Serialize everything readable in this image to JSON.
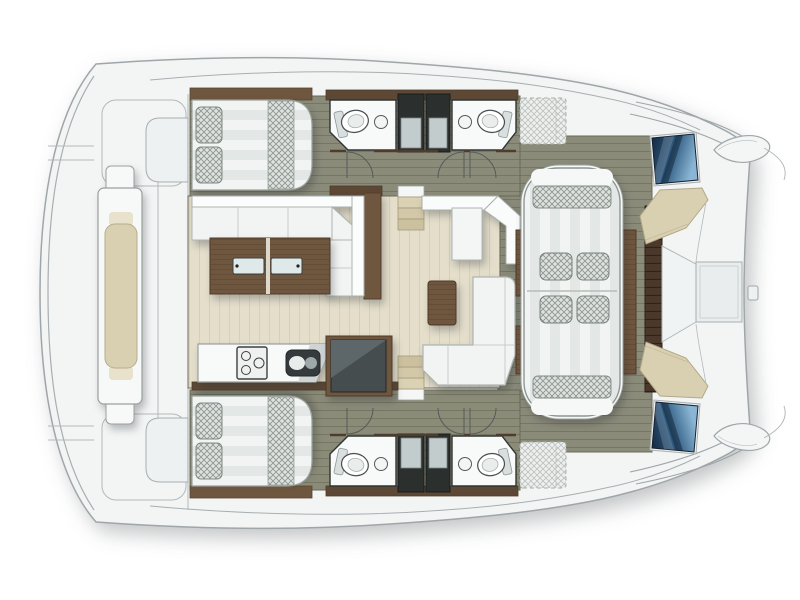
{
  "document": {
    "title": "Catamaran interior layout plan",
    "view": "top-down deck plan",
    "bow_direction": "right",
    "stern_direction": "left"
  },
  "colors": {
    "background": "#ffffff",
    "deck": "#f3f5f5",
    "deckRecess": "#eef1f1",
    "outline": "#9fa6a9",
    "hullFloor": "#8b8b7a",
    "hullFloorLine": "#77775f",
    "salonFloor": "#e4decb",
    "salonFloorLine": "#d7d0b8",
    "wood": "#6f563f",
    "woodLine": "#5e4730",
    "slatWood": "#4a382a",
    "wallWood": "#5d4836",
    "fixtureDark": "#2b2f2e",
    "applianceDark": "#454d4e",
    "upholstery": "#f2f4f3",
    "upholsteryStripe": "#e3e8e6",
    "crosshatchFabric": "#dde2df",
    "crosshatchLine": "#8f9792",
    "cushionBeige": "#d9d0b2",
    "stepBeige": "#dbd2b4",
    "glass": "#dfe9e9",
    "sinkDark": "#353b3d",
    "hatchBlueDark": "#13293f",
    "hatchBlueMid": "#2e5a80",
    "hatchBlueLight": "#8ab5d4"
  },
  "features": [
    {
      "name": "boat-hull-silhouette",
      "label": "Catamaran deck outline, bow to the right"
    },
    {
      "name": "aft-platform",
      "label": "Aft platform / transom deck"
    },
    {
      "name": "aft-bench",
      "label": "Central aft bench with beige cushion"
    },
    {
      "name": "port-hull-floor",
      "label": "Port hull cabin sole (top)"
    },
    {
      "name": "starboard-hull-floor",
      "label": "Starboard hull cabin sole (bottom)"
    },
    {
      "name": "aft-cabin-bed",
      "label": "Double berth with two pillows and runner (one per hull)"
    },
    {
      "name": "head-compartment",
      "label": "Bathroom with toilet and washbasin (two per hull side)"
    },
    {
      "name": "shower-column",
      "label": "Shower stall column"
    },
    {
      "name": "door-swing",
      "label": "Door swing arc"
    },
    {
      "name": "salon-floor",
      "label": "Central salon floor"
    },
    {
      "name": "salon-sofa",
      "label": "L-shaped salon sofa"
    },
    {
      "name": "coffee-table",
      "label": "Wooden coffee table with twin glass inserts"
    },
    {
      "name": "galley-counter",
      "label": "Galley counter"
    },
    {
      "name": "stove",
      "label": "Three-burner stove"
    },
    {
      "name": "sink",
      "label": "Double galley sink"
    },
    {
      "name": "fridge",
      "label": "Refrigerator unit in wood surround"
    },
    {
      "name": "chart-counter",
      "label": "Forward-facing counter with seat"
    },
    {
      "name": "stool",
      "label": "Wooden stool / side table"
    },
    {
      "name": "forward-sofa",
      "label": "L-shaped forward salon sofa"
    },
    {
      "name": "companionway-steps",
      "label": "Steps down into each hull"
    },
    {
      "name": "forward-cockpit-floor",
      "label": "Forward cockpit deck"
    },
    {
      "name": "forward-lounge",
      "label": "Forward cockpit lounge with four cushions"
    },
    {
      "name": "lounge-side-table",
      "label": "Wooden side tables flanking lounge"
    },
    {
      "name": "forward-bench-slats",
      "label": "Slatted forward bench"
    },
    {
      "name": "foredeck-bench",
      "label": "Angled beige foredeck bench"
    },
    {
      "name": "anchor-locker",
      "label": "Recessed foredeck locker"
    },
    {
      "name": "bow-hatch",
      "label": "Blue glazed bow hatch (one per hull)"
    },
    {
      "name": "bow-tip",
      "label": "Bow tip"
    },
    {
      "name": "deck-sunpad",
      "label": "Optional side-deck sunpad (dashed)"
    },
    {
      "name": "cleat",
      "label": "Bow fitting"
    }
  ]
}
